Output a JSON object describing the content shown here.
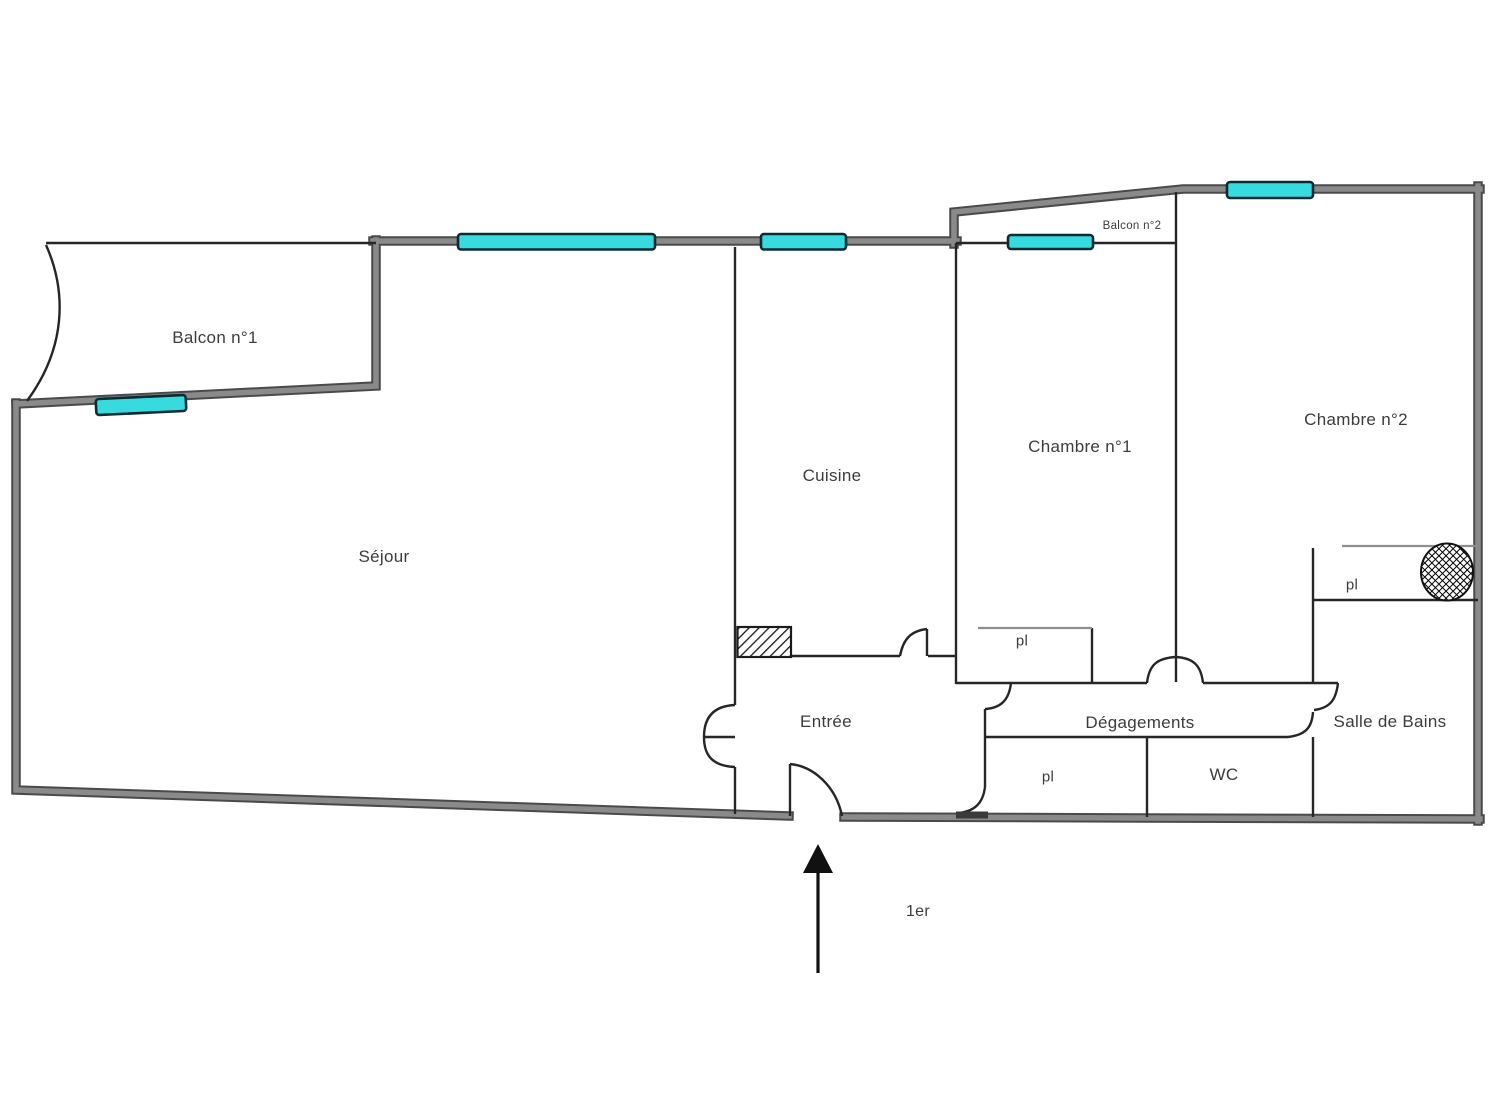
{
  "labels": {
    "balcon1": "Balcon n°1",
    "sejour": "Séjour",
    "cuisine": "Cuisine",
    "chambre1": "Chambre n°1",
    "chambre2": "Chambre n°2",
    "balcon2": "Balcon n°2",
    "entree": "Entrée",
    "degagements": "Dégagements",
    "salle_de_bains": "Salle de Bains",
    "wc": "WC",
    "closet": "pl",
    "floor_level": "1er"
  },
  "colors": {
    "background": "#ffffff",
    "wall_core": "#8a8a8a",
    "wall_edge": "#4a4a4a",
    "interior_line": "#262626",
    "closet_line": "#8e8e8e",
    "window_fill": "#37dbdf",
    "window_border": "#0b2b33",
    "text": "#3c3c3c",
    "arrow": "#111111"
  }
}
